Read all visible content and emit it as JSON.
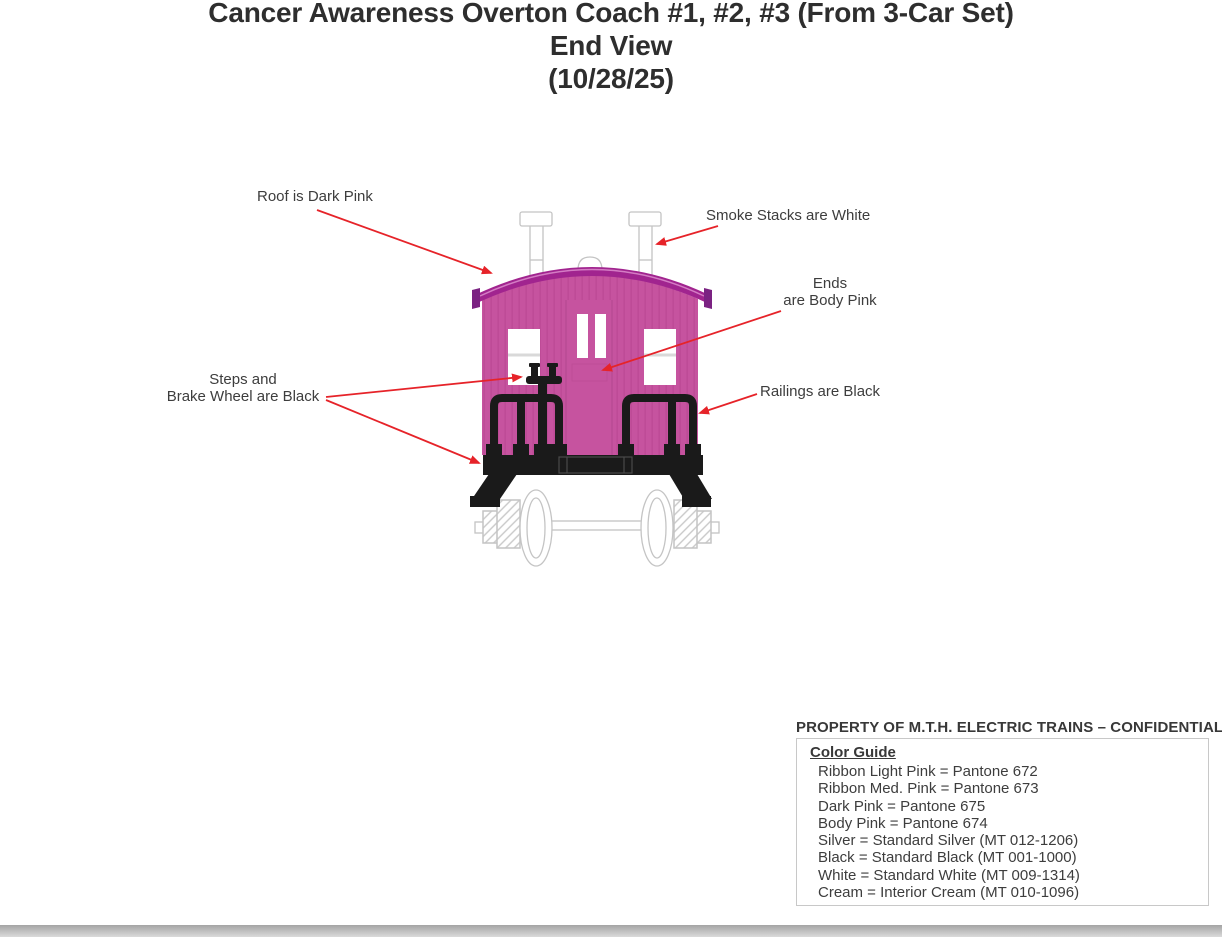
{
  "title": {
    "line1": "Cancer Awareness Overton Coach #1, #2, #3 (From 3-Car Set)",
    "line2": "End View",
    "line3": "(10/28/25)"
  },
  "annotations": {
    "roof": "Roof is Dark Pink",
    "smoke_stacks": "Smoke Stacks are White",
    "ends": {
      "line1": "Ends",
      "line2": "are Body Pink"
    },
    "steps": {
      "line1": "Steps and",
      "line2": "Brake Wheel are Black"
    },
    "railings": "Railings are Black"
  },
  "footer": {
    "property_notice": "PROPERTY OF M.T.H. ELECTRIC TRAINS – CONFIDENTIAL",
    "color_guide": {
      "heading": "Color Guide",
      "items": [
        "Ribbon Light Pink = Pantone 672",
        "Ribbon Med. Pink = Pantone 673",
        "Dark Pink = Pantone 675",
        "Body Pink = Pantone 674",
        "Silver = Standard Silver (MT 012-1206)",
        "Black = Standard Black (MT 001-1000)",
        "White = Standard White (MT 009-1314)",
        "Cream = Interior Cream (MT 010-1096)"
      ]
    }
  },
  "diagram": {
    "subject": "Overton coach end view",
    "colors": {
      "body_pink": "#c6539f",
      "dark_pink": "#a1248f",
      "black": "#1a1a1a",
      "white": "#ffffff",
      "outline_gray": "#c4c4c4",
      "arrow_red": "#e62329"
    }
  }
}
